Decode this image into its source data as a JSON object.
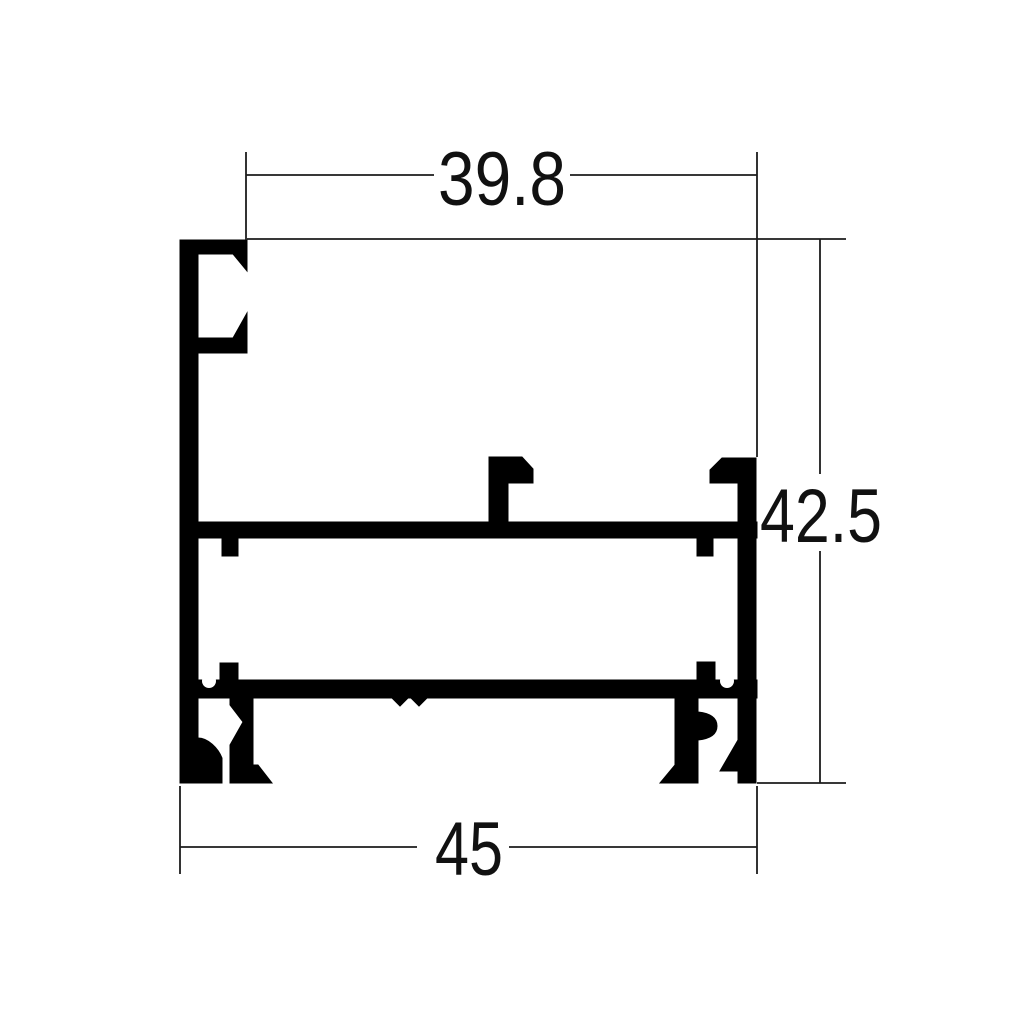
{
  "page": {
    "background_color": "#ffffff",
    "drawing_color": "#000000"
  },
  "drawing": {
    "kind": "aluminium-extrusion-profile-cross-section",
    "dimensions": {
      "top_width": "39.8",
      "height": "42.5",
      "bottom_width": "45"
    }
  }
}
